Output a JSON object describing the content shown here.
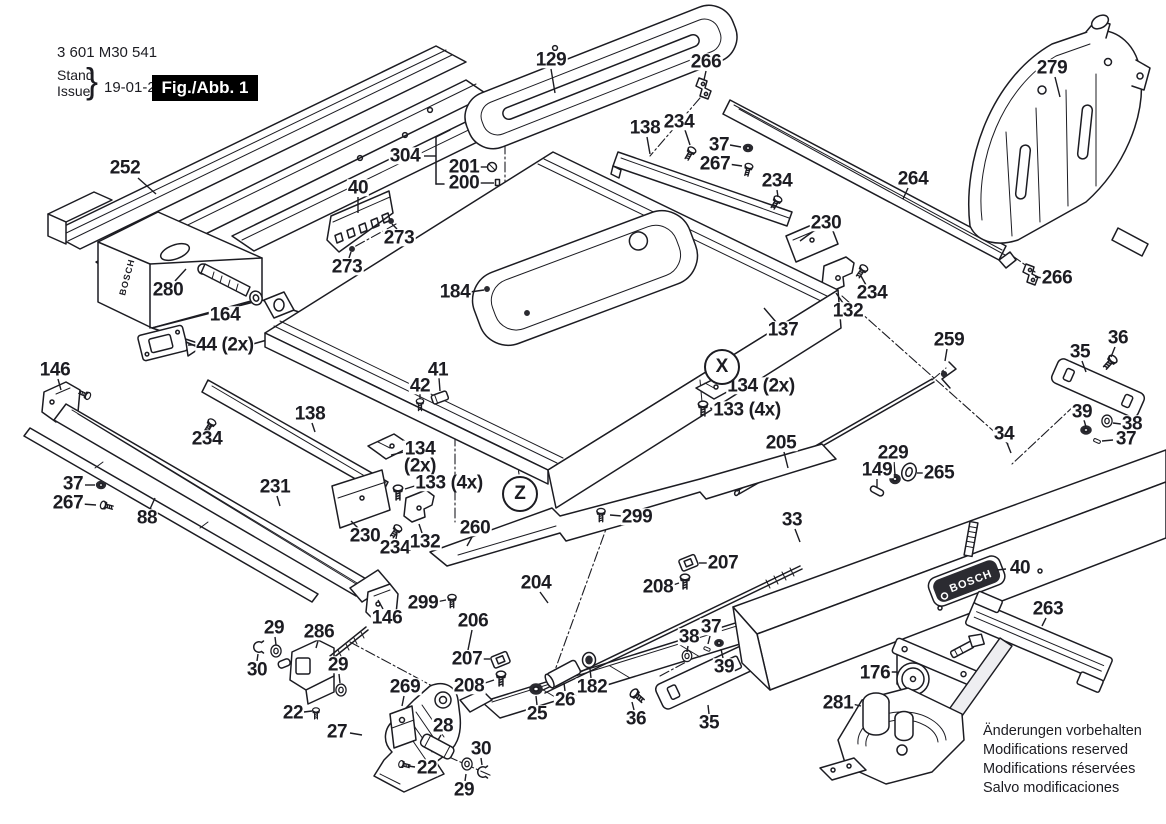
{
  "colors": {
    "ink": "#1c1c22",
    "paper": "#ffffff",
    "fig_box_bg": "#000000",
    "fig_box_fg": "#ffffff"
  },
  "brand": {
    "name": "BOSCH"
  },
  "header": {
    "part_number": "3 601 M30 541",
    "stand_label": "Stand",
    "issue_label": "Issue",
    "brace": "}",
    "date": "19-01-24",
    "figure_label": "Fig./Abb. 1"
  },
  "notes": {
    "lines": [
      "Änderungen vorbehalten",
      "Modifications reserved",
      "Modifications réservées",
      "Salvo modificaciones"
    ]
  },
  "section_markers": [
    {
      "letter": "X",
      "x": 722,
      "y": 367
    },
    {
      "letter": "Z",
      "x": 520,
      "y": 494
    }
  ],
  "callouts": [
    {
      "label": "252",
      "x": 125,
      "y": 168,
      "line": [
        138,
        178,
        156,
        194
      ]
    },
    {
      "label": "304",
      "x": 405,
      "y": 156,
      "line": [
        424,
        156,
        436,
        156
      ]
    },
    {
      "label": "201",
      "x": 464,
      "y": 167,
      "line": [
        478,
        167,
        488,
        167
      ]
    },
    {
      "label": "200",
      "x": 464,
      "y": 183,
      "line": [
        478,
        183,
        494,
        183
      ]
    },
    {
      "label": "129",
      "x": 551,
      "y": 60,
      "line": [
        551,
        69,
        555,
        93
      ]
    },
    {
      "label": "266",
      "x": 706,
      "y": 62,
      "line": [
        706,
        71,
        704,
        80
      ]
    },
    {
      "label": "138",
      "x": 645,
      "y": 128,
      "line": [
        647,
        137,
        650,
        154
      ]
    },
    {
      "label": "234",
      "x": 679,
      "y": 122,
      "line": [
        685,
        130,
        690,
        145
      ]
    },
    {
      "label": "37",
      "x": 719,
      "y": 145,
      "line": [
        730,
        145,
        741,
        147
      ]
    },
    {
      "label": "267",
      "x": 715,
      "y": 164,
      "line": [
        728,
        164,
        742,
        166
      ]
    },
    {
      "label": "234",
      "x": 777,
      "y": 181,
      "line": [
        777,
        190,
        778,
        197
      ]
    },
    {
      "label": "264",
      "x": 913,
      "y": 179,
      "line": [
        908,
        188,
        903,
        199
      ]
    },
    {
      "label": "279",
      "x": 1052,
      "y": 68,
      "line": [
        1055,
        77,
        1060,
        97
      ]
    },
    {
      "label": "266",
      "x": 1057,
      "y": 278,
      "line": [
        1044,
        278,
        1035,
        277
      ]
    },
    {
      "label": "230",
      "x": 826,
      "y": 223,
      "line": [
        815,
        230,
        800,
        241
      ]
    },
    {
      "label": "234",
      "x": 872,
      "y": 293,
      "line": [
        866,
        285,
        861,
        276
      ]
    },
    {
      "label": "132",
      "x": 848,
      "y": 311,
      "line": [
        843,
        303,
        836,
        293
      ]
    },
    {
      "label": "137",
      "x": 783,
      "y": 330,
      "line": [
        776,
        322,
        764,
        308
      ]
    },
    {
      "label": "184",
      "x": 455,
      "y": 292,
      "line": [
        470,
        292,
        484,
        290
      ]
    },
    {
      "label": "40",
      "x": 358,
      "y": 188,
      "line": [
        358,
        197,
        358,
        213
      ]
    },
    {
      "label": "273",
      "x": 399,
      "y": 238,
      "line": [
        397,
        229,
        392,
        224
      ]
    },
    {
      "label": "273",
      "x": 347,
      "y": 267,
      "line": [
        349,
        258,
        351,
        252
      ]
    },
    {
      "label": "280",
      "x": 168,
      "y": 290,
      "line": [
        175,
        281,
        186,
        269
      ]
    },
    {
      "label": "164",
      "x": 225,
      "y": 315
    },
    {
      "label": "44 (2x)",
      "x": 225,
      "y": 345,
      "line": [
        197,
        345,
        188,
        345
      ]
    },
    {
      "label": "146",
      "x": 55,
      "y": 370,
      "line": [
        58,
        379,
        61,
        390
      ]
    },
    {
      "label": "42",
      "x": 420,
      "y": 386,
      "line": [
        420,
        394,
        420,
        399
      ]
    },
    {
      "label": "41",
      "x": 438,
      "y": 370,
      "line": [
        439,
        378,
        440,
        391
      ]
    },
    {
      "label": "134 (2x)",
      "x": 761,
      "y": 386,
      "line": [
        737,
        386,
        728,
        386
      ]
    },
    {
      "label": "133 (4x)",
      "x": 747,
      "y": 410,
      "line": [
        720,
        410,
        710,
        408
      ]
    },
    {
      "label": "259",
      "x": 949,
      "y": 340,
      "line": [
        947,
        349,
        945,
        361
      ]
    },
    {
      "label": "36",
      "x": 1118,
      "y": 338,
      "line": [
        1115,
        347,
        1111,
        357
      ]
    },
    {
      "label": "35",
      "x": 1080,
      "y": 352,
      "line": [
        1082,
        361,
        1086,
        372
      ]
    },
    {
      "label": "39",
      "x": 1082,
      "y": 412,
      "line": [
        1084,
        420,
        1086,
        427
      ]
    },
    {
      "label": "38",
      "x": 1132,
      "y": 424,
      "line": [
        1121,
        424,
        1113,
        423
      ]
    },
    {
      "label": "37",
      "x": 1126,
      "y": 439,
      "line": [
        1113,
        440,
        1102,
        441
      ]
    },
    {
      "label": "34",
      "x": 1004,
      "y": 434,
      "line": [
        1007,
        443,
        1011,
        453
      ]
    },
    {
      "label": "205",
      "x": 781,
      "y": 443,
      "line": [
        784,
        452,
        788,
        468
      ]
    },
    {
      "label": "229",
      "x": 893,
      "y": 453,
      "line": [
        894,
        462,
        895,
        475
      ]
    },
    {
      "label": "149",
      "x": 877,
      "y": 470,
      "line": [
        877,
        479,
        877,
        488
      ]
    },
    {
      "label": "265",
      "x": 939,
      "y": 473,
      "line": [
        926,
        473,
        917,
        473
      ]
    },
    {
      "label": "33",
      "x": 792,
      "y": 520,
      "line": [
        795,
        529,
        800,
        542
      ]
    },
    {
      "label": "234",
      "x": 207,
      "y": 439,
      "line": [
        209,
        430,
        211,
        424
      ]
    },
    {
      "label": "138",
      "x": 310,
      "y": 414,
      "line": [
        312,
        423,
        315,
        432
      ]
    },
    {
      "label": "37",
      "x": 73,
      "y": 484,
      "line": [
        85,
        485,
        95,
        485
      ]
    },
    {
      "label": "267",
      "x": 68,
      "y": 503,
      "line": [
        82,
        504,
        96,
        505
      ]
    },
    {
      "label": "88",
      "x": 147,
      "y": 518,
      "line": [
        150,
        509,
        155,
        498
      ]
    },
    {
      "label": "231",
      "x": 275,
      "y": 487,
      "line": [
        277,
        496,
        280,
        506
      ]
    },
    {
      "label": "230",
      "x": 365,
      "y": 536,
      "line": [
        358,
        528,
        351,
        521
      ]
    },
    {
      "label": "234",
      "x": 395,
      "y": 548,
      "line": [
        396,
        539,
        397,
        533
      ]
    },
    {
      "label": "132",
      "x": 425,
      "y": 542,
      "line": [
        422,
        533,
        419,
        524
      ]
    },
    {
      "label": "134\n(2x)",
      "x": 420,
      "y": 458,
      "line": [
        404,
        452,
        391,
        455
      ]
    },
    {
      "label": "133 (4x)",
      "x": 449,
      "y": 483,
      "line": [
        421,
        484,
        405,
        489
      ]
    },
    {
      "label": "260",
      "x": 475,
      "y": 528,
      "line": [
        472,
        537,
        467,
        546
      ]
    },
    {
      "label": "299",
      "x": 637,
      "y": 517,
      "line": [
        622,
        516,
        610,
        515
      ]
    },
    {
      "label": "299",
      "x": 423,
      "y": 603,
      "line": [
        436,
        602,
        446,
        600
      ]
    },
    {
      "label": "146",
      "x": 387,
      "y": 618,
      "line": [
        383,
        609,
        378,
        600
      ]
    },
    {
      "label": "204",
      "x": 536,
      "y": 583,
      "line": [
        540,
        592,
        548,
        603
      ]
    },
    {
      "label": "206",
      "x": 473,
      "y": 621,
      "line": [
        472,
        630,
        468,
        650
      ]
    },
    {
      "label": "207",
      "x": 467,
      "y": 659,
      "line": [
        480,
        659,
        490,
        659
      ]
    },
    {
      "label": "208",
      "x": 469,
      "y": 686,
      "line": [
        482,
        684,
        494,
        680
      ]
    },
    {
      "label": "207",
      "x": 723,
      "y": 563,
      "line": [
        709,
        563,
        699,
        563
      ]
    },
    {
      "label": "208",
      "x": 658,
      "y": 587,
      "line": [
        670,
        586,
        679,
        583
      ]
    },
    {
      "label": "25",
      "x": 537,
      "y": 714,
      "line": [
        537,
        705,
        536,
        696
      ]
    },
    {
      "label": "26",
      "x": 565,
      "y": 700,
      "line": [
        565,
        691,
        564,
        683
      ]
    },
    {
      "label": "182",
      "x": 592,
      "y": 687,
      "line": [
        591,
        678,
        590,
        669
      ]
    },
    {
      "label": "36",
      "x": 636,
      "y": 719,
      "line": [
        634,
        710,
        632,
        702
      ]
    },
    {
      "label": "35",
      "x": 709,
      "y": 723,
      "line": [
        709,
        714,
        708,
        705
      ]
    },
    {
      "label": "38",
      "x": 689,
      "y": 637,
      "line": [
        688,
        646,
        687,
        652
      ]
    },
    {
      "label": "37",
      "x": 711,
      "y": 627,
      "line": [
        710,
        636,
        708,
        644
      ]
    },
    {
      "label": "39",
      "x": 724,
      "y": 667,
      "line": [
        723,
        658,
        721,
        649
      ]
    },
    {
      "label": "29",
      "x": 274,
      "y": 628,
      "line": [
        275,
        637,
        276,
        645
      ]
    },
    {
      "label": "286",
      "x": 319,
      "y": 632,
      "line": [
        318,
        641,
        316,
        648
      ]
    },
    {
      "label": "30",
      "x": 257,
      "y": 670,
      "line": [
        257,
        661,
        258,
        654
      ]
    },
    {
      "label": "29",
      "x": 338,
      "y": 665,
      "line": [
        339,
        674,
        340,
        683
      ]
    },
    {
      "label": "22",
      "x": 293,
      "y": 713,
      "line": [
        304,
        712,
        312,
        711
      ]
    },
    {
      "label": "27",
      "x": 337,
      "y": 732,
      "line": [
        350,
        733,
        362,
        735
      ]
    },
    {
      "label": "269",
      "x": 405,
      "y": 687,
      "line": [
        404,
        696,
        402,
        706
      ]
    },
    {
      "label": "28",
      "x": 443,
      "y": 726,
      "line": [
        441,
        735,
        438,
        740
      ]
    },
    {
      "label": "22",
      "x": 427,
      "y": 768,
      "line": [
        415,
        767,
        408,
        766
      ]
    },
    {
      "label": "30",
      "x": 481,
      "y": 749,
      "line": [
        481,
        758,
        482,
        765
      ]
    },
    {
      "label": "29",
      "x": 464,
      "y": 790,
      "line": [
        465,
        781,
        466,
        774
      ]
    },
    {
      "label": "40",
      "x": 1020,
      "y": 568,
      "line": [
        1006,
        569,
        997,
        570
      ]
    },
    {
      "label": "263",
      "x": 1048,
      "y": 609,
      "line": [
        1046,
        618,
        1042,
        626
      ]
    },
    {
      "label": "176",
      "x": 875,
      "y": 673
    },
    {
      "label": "281",
      "x": 838,
      "y": 703,
      "line": [
        852,
        704,
        861,
        706
      ]
    }
  ]
}
